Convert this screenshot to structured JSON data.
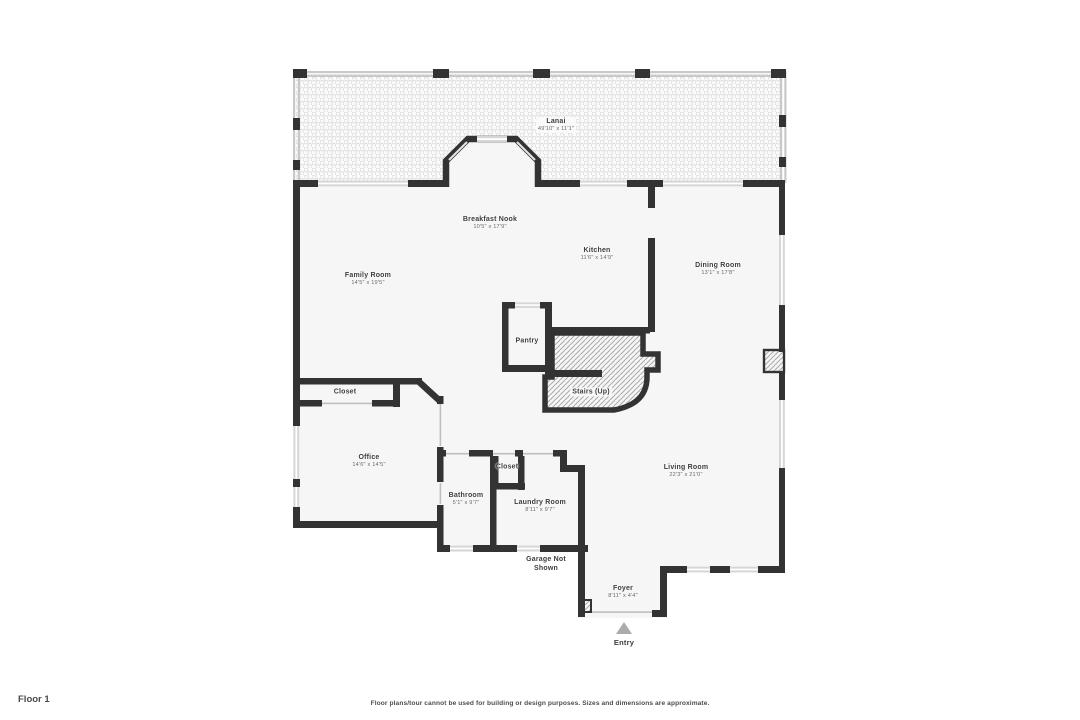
{
  "colors": {
    "wall": "#333333",
    "window": "#d6d6d6",
    "floor": "#f6f6f6",
    "stair_hatch": "#a9a9a9",
    "lanai_dots": "#dcdcdc",
    "entry_marker": "#ababab",
    "room_label_text": "#3d3d3d",
    "dimension_text": "#666666"
  },
  "rooms": {
    "lanai": {
      "name": "Lanai",
      "dims": "49'10\" x 11'1\""
    },
    "breakfast_nook": {
      "name": "Breakfast Nook",
      "dims": "10'5\" x 17'9\""
    },
    "kitchen": {
      "name": "Kitchen",
      "dims": "11'6\" x 14'9\""
    },
    "dining_room": {
      "name": "Dining Room",
      "dims": "13'1\" x 17'8\""
    },
    "family_room": {
      "name": "Family Room",
      "dims": "14'5\" x 19'5\""
    },
    "pantry": {
      "name": "Pantry"
    },
    "stairs": {
      "name": "Stairs (Up)"
    },
    "closet_hall": {
      "name": "Closet"
    },
    "office": {
      "name": "Office",
      "dims": "14'6\" x 14'5\""
    },
    "bathroom": {
      "name": "Bathroom",
      "dims": "5'1\" x 9'7\""
    },
    "closet_laundry": {
      "name": "Closet"
    },
    "laundry_room": {
      "name": "Laundry Room",
      "dims": "8'11\" x 9'7\""
    },
    "living_room": {
      "name": "Living Room",
      "dims": "22'3\" x 21'0\""
    },
    "garage_note": {
      "name": "Garage Not Shown"
    },
    "foyer": {
      "name": "Foyer",
      "dims": "8'11\" x 4'4\""
    },
    "entry": {
      "name": "Entry"
    }
  },
  "footer": {
    "floor_label": "Floor 1",
    "disclaimer": "Floor plans/tour cannot be used for building or design purposes. Sizes and dimensions are approximate."
  }
}
